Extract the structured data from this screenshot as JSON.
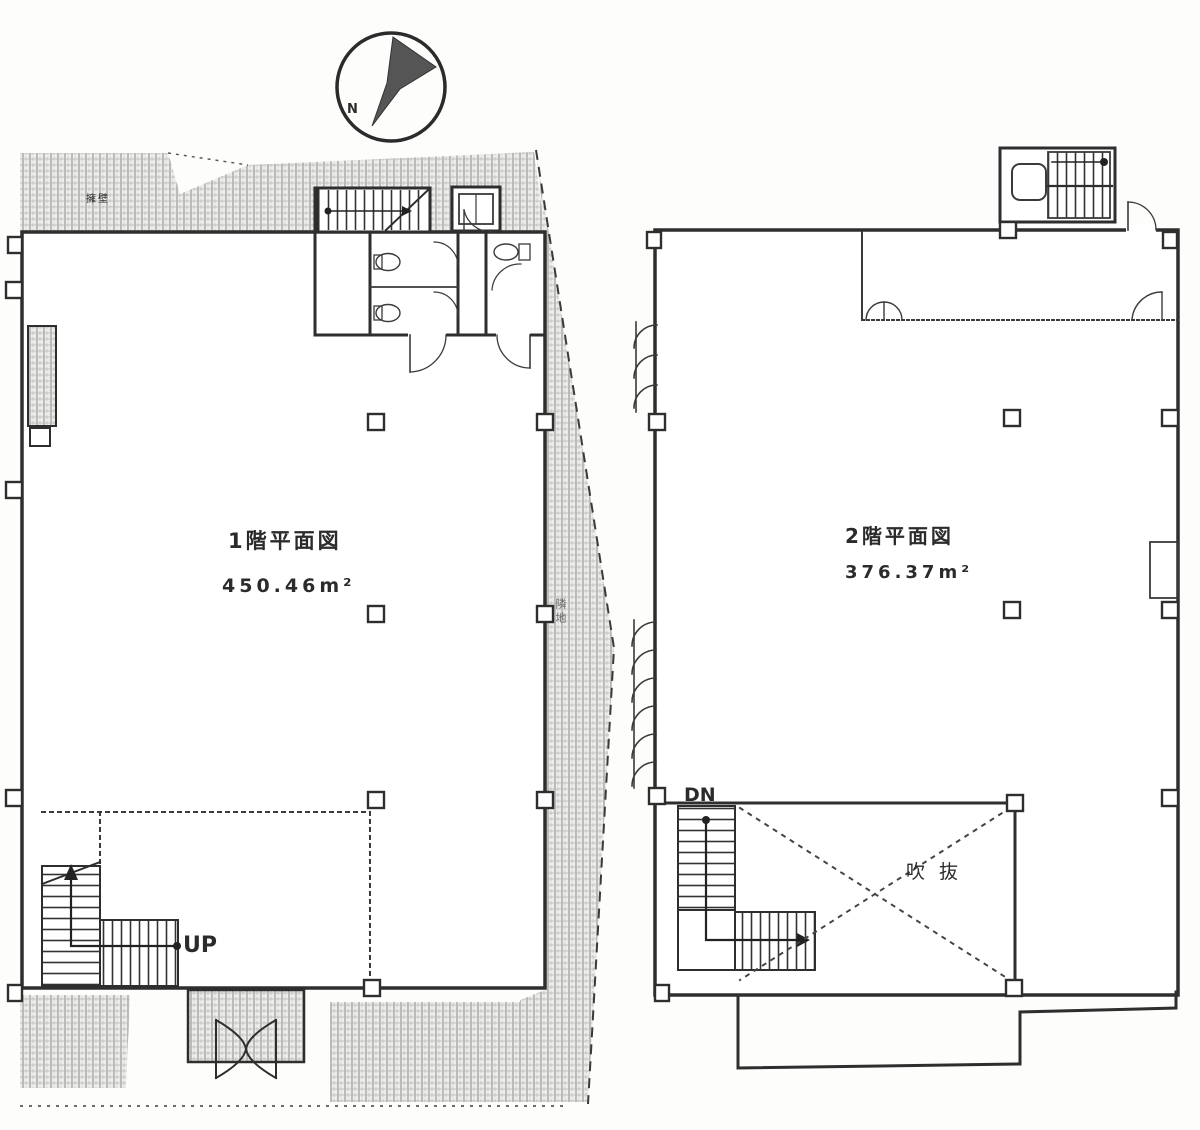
{
  "compass": {
    "north_label": "N"
  },
  "floor1": {
    "title": "1階平面図",
    "area": "450.46m²",
    "stair_direction_label": "UP",
    "site_label_top_left": "擁壁",
    "site_label_right": "隣地"
  },
  "floor2": {
    "title": "2階平面図",
    "area": "376.37m²",
    "stair_direction_label": "DN",
    "void_label": "吹抜"
  }
}
